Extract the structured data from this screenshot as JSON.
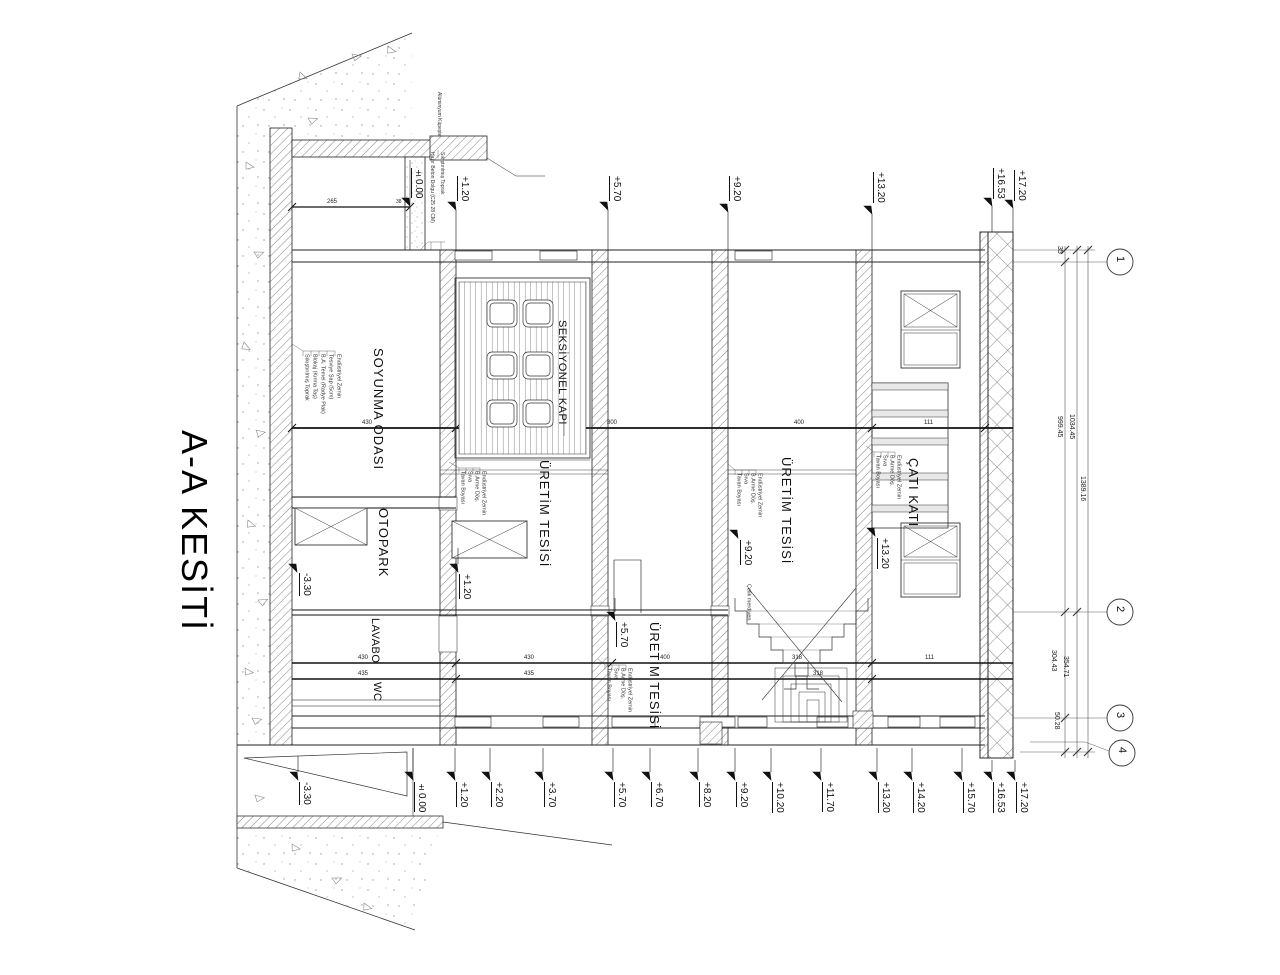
{
  "title": "A-A KESİTİ",
  "rooms": {
    "soyunma": "SOYUNMA ODASI",
    "otopark": "OTOPARK",
    "lavabo": "LAVABO",
    "wc": "WC",
    "kapi": "SEKSİYONEL KAPI",
    "uretim1": "ÜRETİM TESİSİ",
    "uretim2": "ÜRETİM TESİSİ",
    "uretim3": "ÜRETİM TESİSİ",
    "cati": "ÇATI KATI"
  },
  "levels_top": [
    "±0.00",
    "+1.20",
    "+5.70",
    "+9.20",
    "+13.20",
    "+16.53",
    "+17.20"
  ],
  "levels_bottom": [
    "-3.30",
    "±0.00",
    "+1.20",
    "+2.20",
    "+3.70",
    "+5.70",
    "+6.70",
    "+8.20",
    "+9.20",
    "+10.20",
    "+11.70",
    "+13.20",
    "+14.20",
    "+15.70",
    "+16.53",
    "+17.20"
  ],
  "levels_inner": [
    "-3.30",
    "+1.20",
    "+5.70",
    "+9.20",
    "+13.20"
  ],
  "grid_axes": [
    "1",
    "2",
    "3",
    "4"
  ],
  "dims_right": {
    "d35": "35",
    "d999": "999.45",
    "d1034": "1034.45",
    "d1389": "1389.16",
    "d304": "304.43",
    "d354": "354.71",
    "d50": "50.28"
  },
  "dims_mid": [
    "430",
    "800",
    "400",
    "111"
  ],
  "dims_low1": [
    "430",
    "430",
    "400",
    "318",
    "111"
  ],
  "dims_low2": [
    "435",
    "435",
    "318"
  ],
  "dims_base": {
    "d265": "265",
    "d38": "38"
  },
  "layers_slab": [
    "Endüstriyel Zemin",
    "B.Arme Döş.",
    "Sıva",
    "Tavan Boyası"
  ],
  "layers_floor": [
    "Endüstriyel Zemin",
    "Tesviye Şap (5cm)",
    "B.A. Temel (Radye Plak)",
    "Blokaj (Kırma Taş)",
    "Sıkıştırılmış Toprak"
  ],
  "notes": {
    "kupeste": "Alüminyum Küpeşte",
    "beton": "Hazır Beton Dolgu (C25 28 CM)",
    "toprak": "Sıkıştırılmış Toprak",
    "merdiven": "Çelik merdiven"
  }
}
